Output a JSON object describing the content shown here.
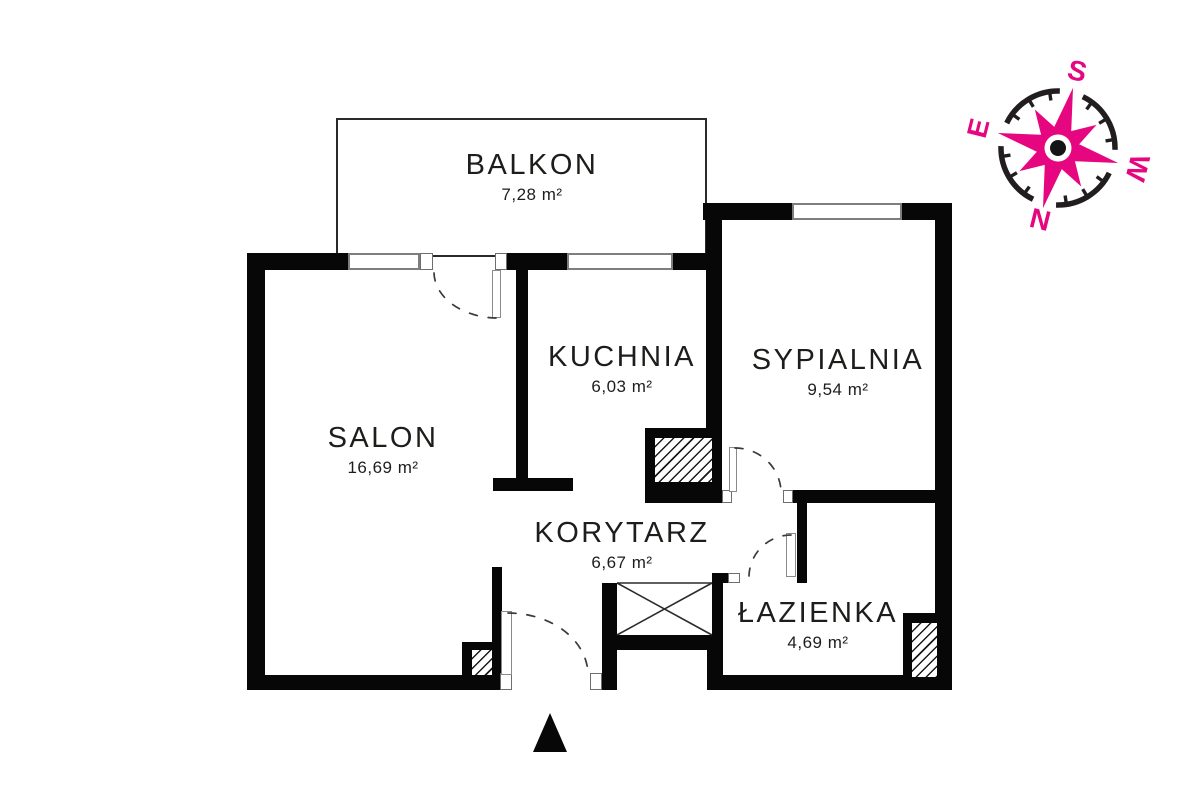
{
  "plan": {
    "rooms": [
      {
        "name": "BALKON",
        "area": "7,28 m²"
      },
      {
        "name": "KUCHNIA",
        "area": "6,03 m²"
      },
      {
        "name": "SYPIALNIA",
        "area": "9,54 m²"
      },
      {
        "name": "SALON",
        "area": "16,69 m²"
      },
      {
        "name": "KORYTARZ",
        "area": "6,67 m²"
      },
      {
        "name": "ŁAZIENKA",
        "area": "4,69 m²"
      }
    ],
    "compass": {
      "top": "S",
      "right": "W",
      "bottom": "N",
      "left": "E",
      "accent_color": "#e6067f"
    },
    "colors": {
      "wall": "#070707",
      "text": "#1d1d1b"
    }
  }
}
